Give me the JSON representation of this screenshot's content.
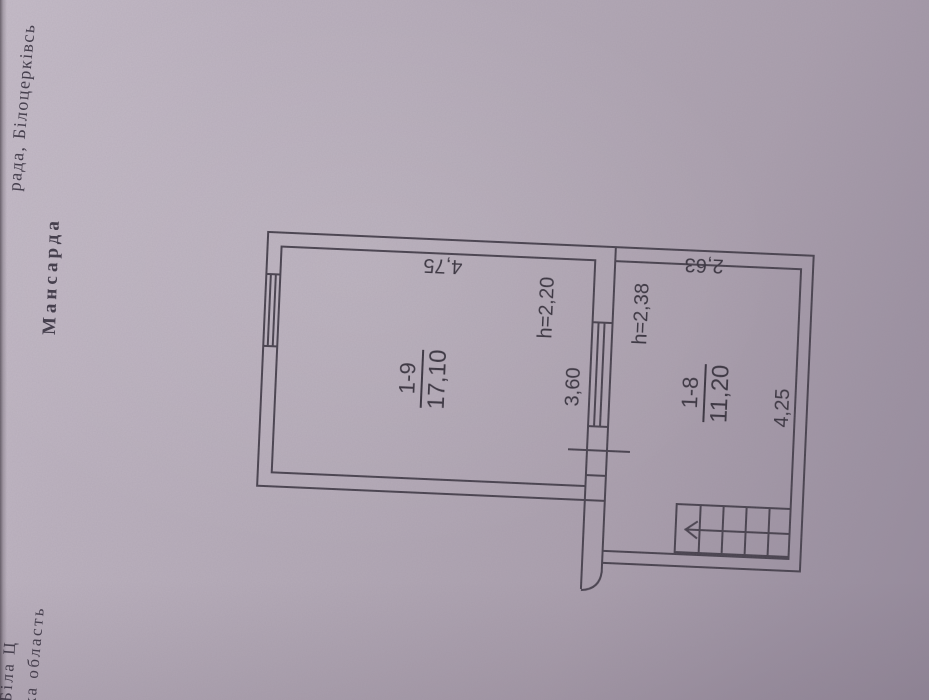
{
  "page": {
    "margin_top_caption": "рада, Білоцерківсь",
    "attic_label": "Мансарда",
    "margin_bottom_line1": "Біла Ц",
    "margin_bottom_line2": "ка область"
  },
  "plan": {
    "room_a": {
      "number": "1-9",
      "area": "17,10",
      "width": "4,75",
      "depth": "3,60",
      "height": "h=2,20"
    },
    "room_b": {
      "number": "1-8",
      "area": "11,20",
      "width": "2,63",
      "depth": "4,25",
      "height": "h=2,38"
    }
  },
  "icons": {
    "stair_direction_arrow": "left-arrow"
  },
  "colors": {
    "paper_base": "#b4aab7",
    "ink": "#46404c",
    "label_text": "#37323d"
  }
}
